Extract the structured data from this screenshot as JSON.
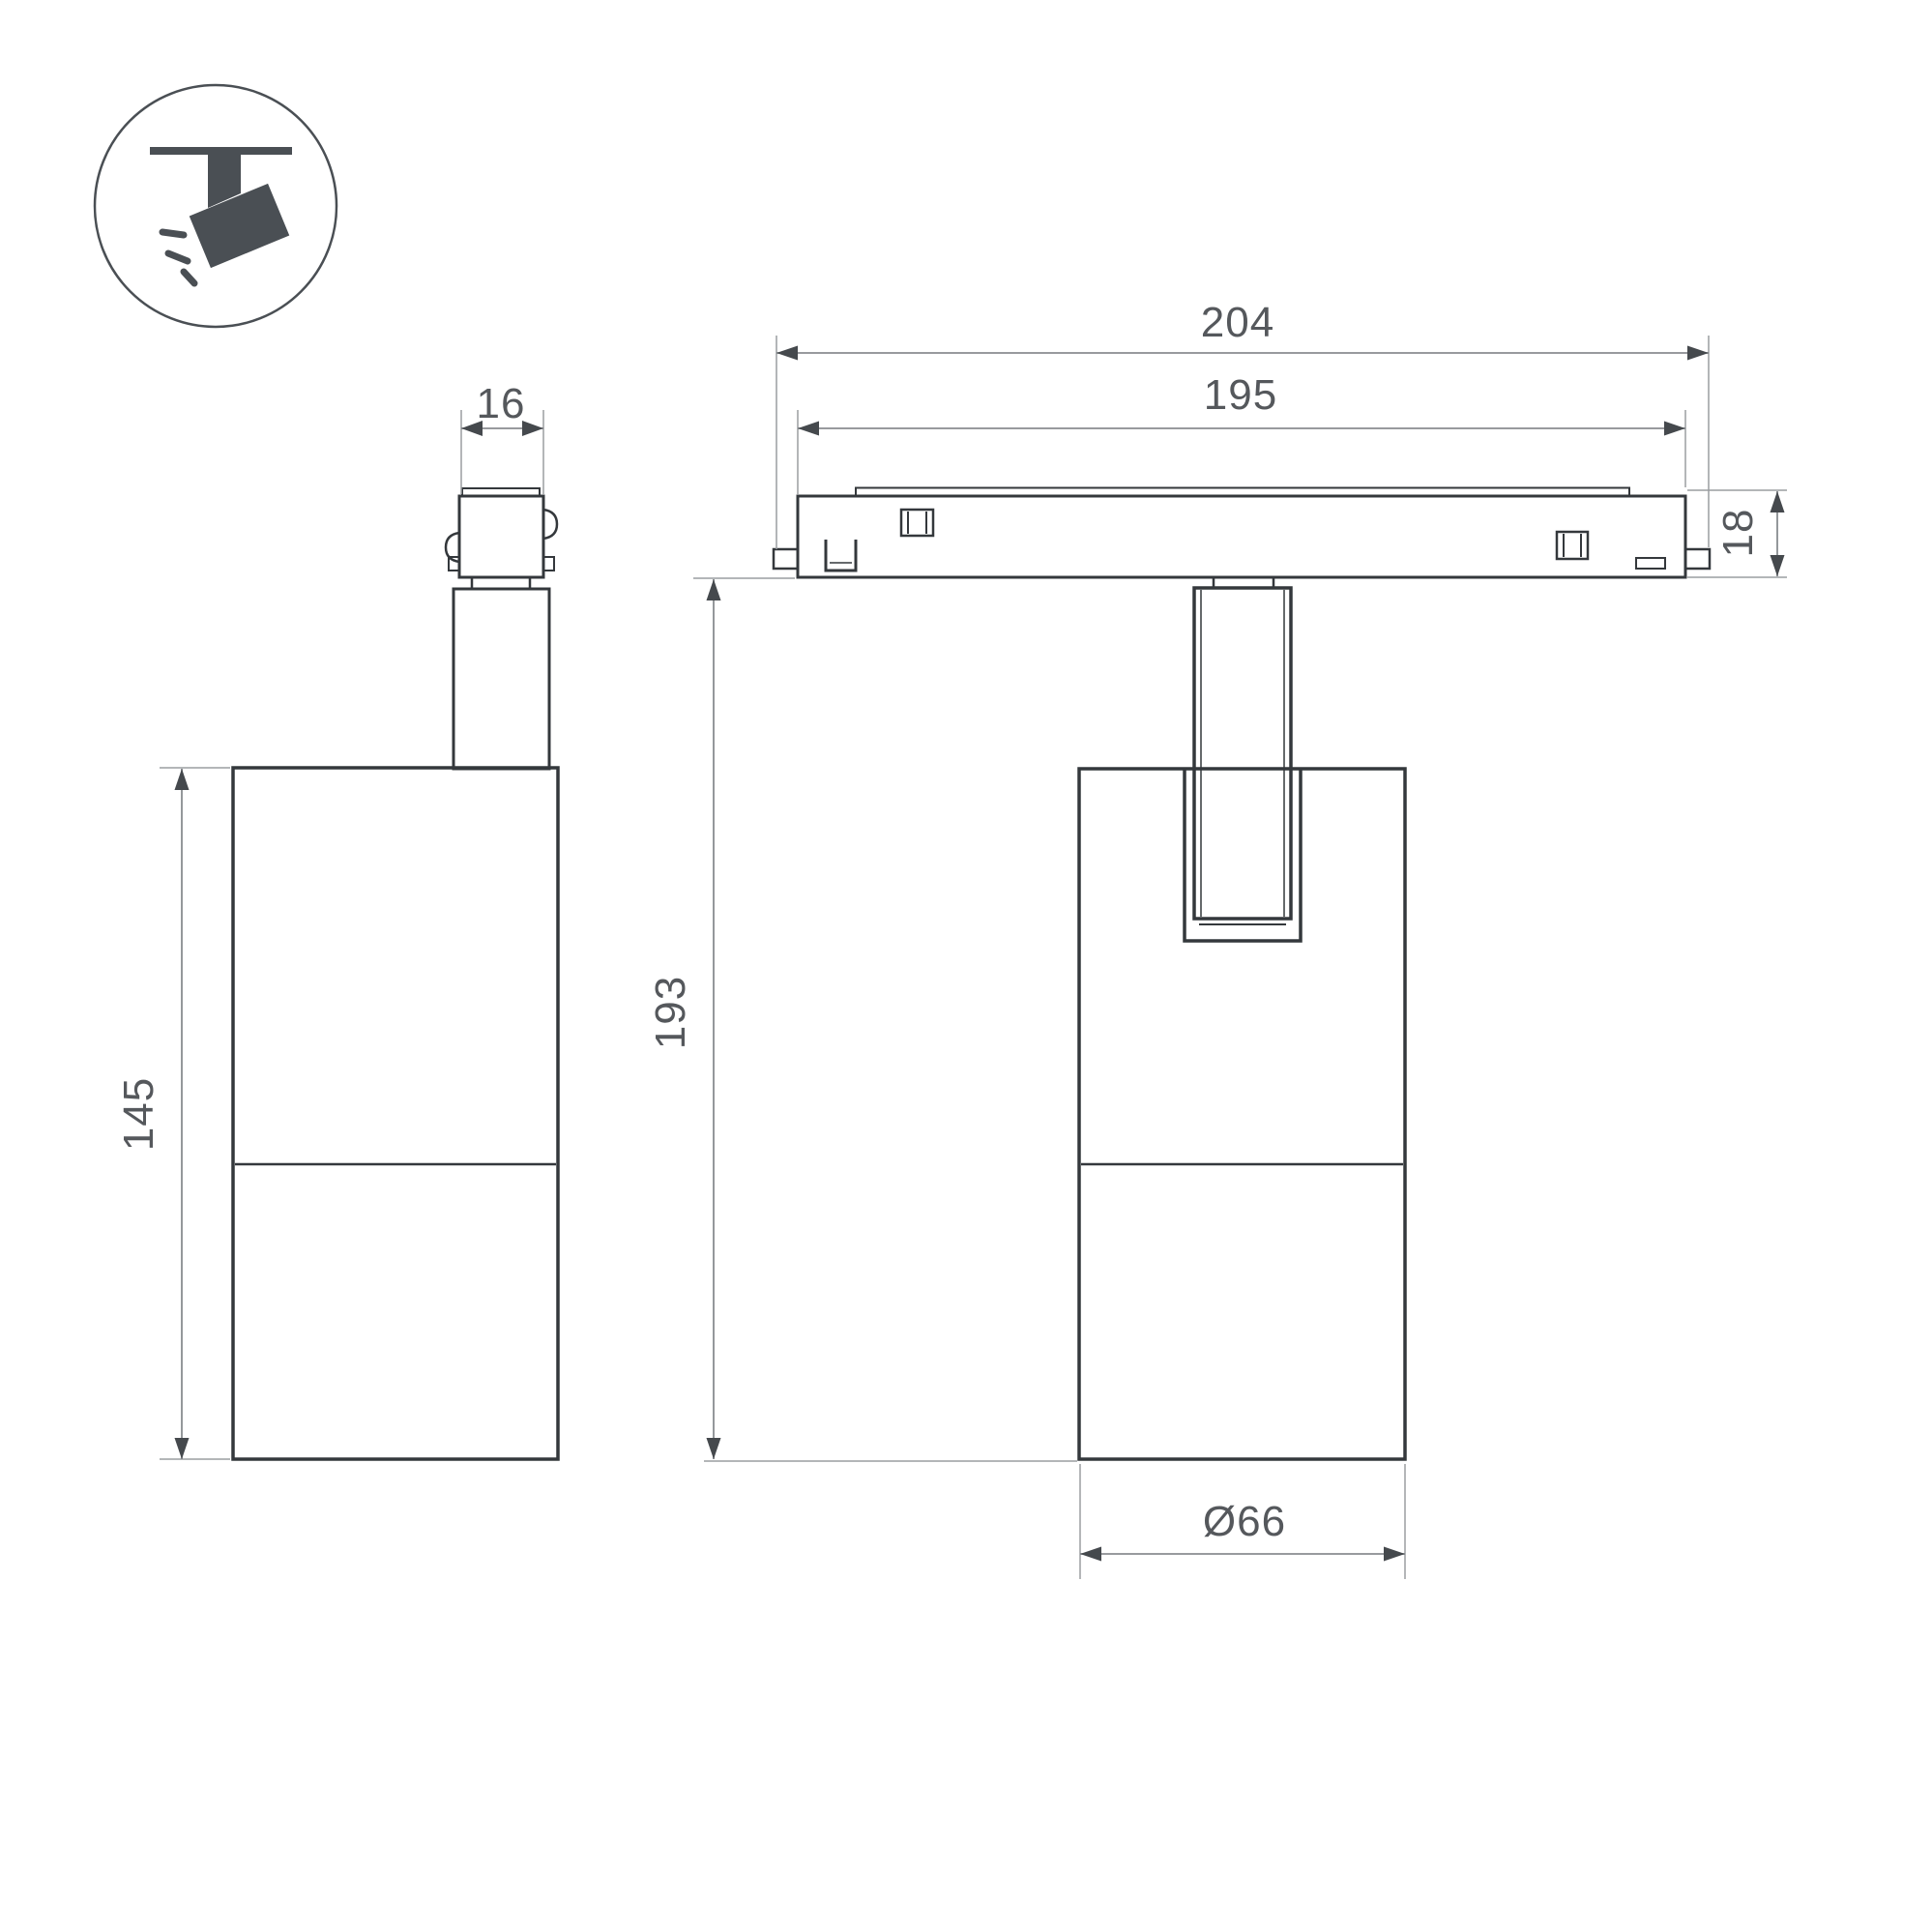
{
  "drawing": {
    "type": "technical-dimension-drawing",
    "subject": "magnetic-track-spotlight",
    "colors": {
      "background": "#ffffff",
      "object_outline": "#34383c",
      "dimension_line": "#898c90",
      "dimension_text": "#55585c",
      "icon": "#4a4f54"
    },
    "icon": {
      "name": "track-spotlight-icon",
      "description": "ceiling track with tilted spotlight emitting rays"
    },
    "side_view": {
      "adapter_width_label": "16",
      "body_height_label": "145"
    },
    "front_view": {
      "track_overall_length_label": "204",
      "track_visible_length_label": "195",
      "track_height_label": "18",
      "fixture_height_label": "193",
      "body_diameter_label": "Ø66"
    }
  }
}
